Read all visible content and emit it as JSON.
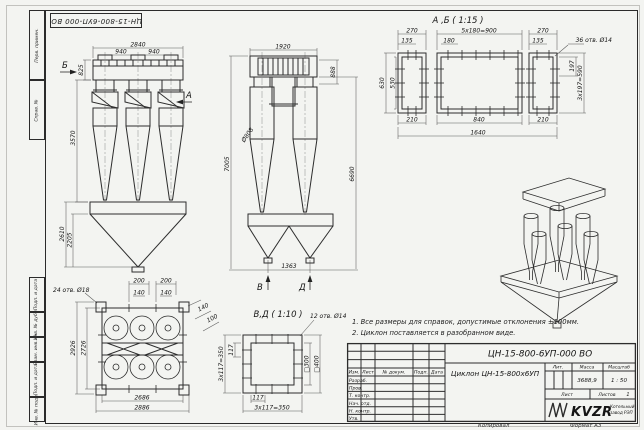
{
  "sheet": {
    "stamp_rotated": "ЦН-15-800-6УП-000 ВО",
    "margin_fields": [
      "Перв. примен.",
      "Справ. №",
      "Подп. и дата",
      "Инв. № дубл.",
      "Взам. инв. №",
      "Подп. и дата",
      "Инв. № подл."
    ],
    "footer": {
      "copied": "Копировал",
      "format": "Формат А3"
    }
  },
  "notes": {
    "line1": "1. Все размеры для справок, допустимые отклонения ±100мм.",
    "line2": "2. Циклон поставляется в разобранном виде."
  },
  "front_view": {
    "label_b": "Б",
    "label_a": "А",
    "dim_total_width": "2840",
    "dim_bay_1": "940",
    "dim_bay_2": "940",
    "dim_inlet_height": "825",
    "dim_body_height": "3570",
    "dim_hopper_height": "2610",
    "dim_cone_height": "2205"
  },
  "side_view": {
    "dim_top_width": "1920",
    "dim_inlet": "888",
    "dim_diameter": "Ø808",
    "dim_total_height": "7005",
    "dim_right_height": "6690",
    "dim_outlet_span": "1363",
    "label_v": "В",
    "label_d": "Д"
  },
  "flange_ab": {
    "title": "А ,Б ( 1:15 )",
    "holes_note": "36 отв. Ø14",
    "dim_270_left": "270",
    "dim_pitch": "5x180=900",
    "dim_270_right": "270",
    "dim_135_left": "135",
    "dim_180": "180",
    "dim_135_right": "135",
    "dim_630": "630",
    "dim_530": "530",
    "dim_197": "197",
    "dim_3x197": "3x197=590",
    "dim_210_left": "210",
    "dim_840": "840",
    "dim_210_right": "210",
    "dim_1640": "1640"
  },
  "plan_view": {
    "holes_note": "24 отв. Ø18",
    "dim_200_1": "200",
    "dim_200_2": "200",
    "dim_140_1": "140",
    "dim_140_2": "140",
    "dim_140_diag": "140",
    "dim_100_diag": "100",
    "dim_2926": "2926",
    "dim_2726": "2726",
    "dim_2686": "2686",
    "dim_2886": "2886"
  },
  "flange_vd": {
    "title": "В,Д ( 1:10 )",
    "holes_note": "12 отв. Ø14",
    "dim_117_left": "117",
    "dim_pitch_left": "3x117=350",
    "dim_117_bottom": "117",
    "dim_pitch_bottom": "3x117=350",
    "dim_sq_300": "□300",
    "dim_sq_400": "□400"
  },
  "title_block": {
    "doc_number": "ЦН-15-800-6УП-000 ВО",
    "product_name": "Циклон ЦН-15-800х6УП",
    "header_cols": {
      "izm": "Изм.",
      "list": "Лист",
      "doc": "№ докум.",
      "podp": "Подп.",
      "data": "Дата"
    },
    "row_labels": [
      "Разраб.",
      "Пров.",
      "Т. контр.",
      "Нач. отд.",
      "Н. контр.",
      "Утв."
    ],
    "lit_label": "Лит.",
    "mass_label": "Масса",
    "scale_label": "Масштаб",
    "mass_value": "3688,9",
    "scale_value": "1 : 50",
    "sheet_label": "Лист",
    "sheets_label": "Листов",
    "sheets_value": "1",
    "logo_text": "KVZR",
    "company_line1": "Котельный",
    "company_line2": "завод РЭП"
  }
}
